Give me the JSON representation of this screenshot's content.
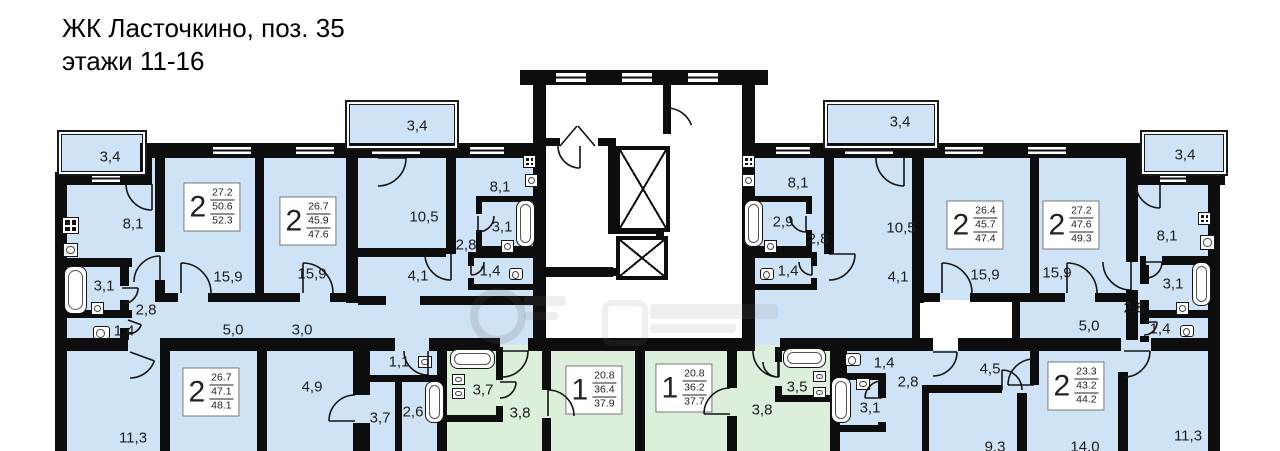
{
  "title": {
    "line1": "ЖК Ласточкино, поз. 35",
    "line2": "этажи 11-16"
  },
  "colors": {
    "room_blue": "#cfe3f6",
    "room_green": "#dcefda",
    "wall": "#0d0d0d"
  },
  "apartments": [
    {
      "rooms": "2",
      "living": "27.2",
      "area": "50.6",
      "total": "52.3",
      "x": 212,
      "y": 207
    },
    {
      "rooms": "2",
      "living": "26.7",
      "area": "45.9",
      "total": "47.6",
      "x": 308,
      "y": 221
    },
    {
      "rooms": "2",
      "living": "26.4",
      "area": "45.7",
      "total": "47.4",
      "x": 975,
      "y": 225
    },
    {
      "rooms": "2",
      "living": "27.2",
      "area": "47.6",
      "total": "49.3",
      "x": 1071,
      "y": 225
    },
    {
      "rooms": "2",
      "living": "26.7",
      "area": "47.1",
      "total": "48.1",
      "x": 211,
      "y": 392
    },
    {
      "rooms": "1",
      "living": "20.8",
      "area": "36.4",
      "total": "37.9",
      "x": 594,
      "y": 390
    },
    {
      "rooms": "1",
      "living": "20.8",
      "area": "36.2",
      "total": "37.7",
      "x": 684,
      "y": 388
    },
    {
      "rooms": "2",
      "living": "23.3",
      "area": "43.2",
      "total": "44.2",
      "x": 1076,
      "y": 386
    }
  ],
  "room_labels": [
    {
      "t": "3,4",
      "x": 110,
      "y": 157
    },
    {
      "t": "8,1",
      "x": 133,
      "y": 224
    },
    {
      "t": "3,1",
      "x": 104,
      "y": 286
    },
    {
      "t": "2,8",
      "x": 146,
      "y": 310
    },
    {
      "t": "1,4",
      "x": 124,
      "y": 331
    },
    {
      "t": "15,9",
      "x": 228,
      "y": 277
    },
    {
      "t": "15,9",
      "x": 312,
      "y": 274
    },
    {
      "t": "5,0",
      "x": 233,
      "y": 330
    },
    {
      "t": "3,0",
      "x": 302,
      "y": 330
    },
    {
      "t": "3,4",
      "x": 417,
      "y": 126
    },
    {
      "t": "10,5",
      "x": 424,
      "y": 217
    },
    {
      "t": "4,1",
      "x": 418,
      "y": 276
    },
    {
      "t": "8,1",
      "x": 500,
      "y": 187
    },
    {
      "t": "3,1",
      "x": 502,
      "y": 227
    },
    {
      "t": "2,8",
      "x": 466,
      "y": 245
    },
    {
      "t": "1,4",
      "x": 490,
      "y": 271
    },
    {
      "t": "3,4",
      "x": 900,
      "y": 122
    },
    {
      "t": "8,1",
      "x": 798,
      "y": 183
    },
    {
      "t": "2,9",
      "x": 783,
      "y": 222
    },
    {
      "t": "2,8",
      "x": 818,
      "y": 239
    },
    {
      "t": "1,4",
      "x": 788,
      "y": 271
    },
    {
      "t": "10,5",
      "x": 901,
      "y": 228
    },
    {
      "t": "4,1",
      "x": 898,
      "y": 277
    },
    {
      "t": "15,9",
      "x": 985,
      "y": 275
    },
    {
      "t": "15,9",
      "x": 1057,
      "y": 273
    },
    {
      "t": "5,0",
      "x": 1089,
      "y": 326
    },
    {
      "t": "2,8",
      "x": 1134,
      "y": 308
    },
    {
      "t": "8,1",
      "x": 1167,
      "y": 236
    },
    {
      "t": "3,1",
      "x": 1173,
      "y": 284
    },
    {
      "t": "1,4",
      "x": 1160,
      "y": 329
    },
    {
      "t": "3,4",
      "x": 1185,
      "y": 155
    },
    {
      "t": "11,3",
      "x": 133,
      "y": 438
    },
    {
      "t": "4,9",
      "x": 312,
      "y": 387
    },
    {
      "t": "1,1",
      "x": 399,
      "y": 362
    },
    {
      "t": "3,7",
      "x": 380,
      "y": 418
    },
    {
      "t": "2,6",
      "x": 413,
      "y": 412
    },
    {
      "t": "3,7",
      "x": 483,
      "y": 390
    },
    {
      "t": "3,8",
      "x": 520,
      "y": 413
    },
    {
      "t": "3,8",
      "x": 762,
      "y": 410
    },
    {
      "t": "3,5",
      "x": 797,
      "y": 387
    },
    {
      "t": "1,4",
      "x": 884,
      "y": 363
    },
    {
      "t": "2,8",
      "x": 908,
      "y": 382
    },
    {
      "t": "3,1",
      "x": 870,
      "y": 408
    },
    {
      "t": "4,5",
      "x": 990,
      "y": 369
    },
    {
      "t": "9,3",
      "x": 995,
      "y": 447
    },
    {
      "t": "14,0",
      "x": 1085,
      "y": 447
    },
    {
      "t": "11,3",
      "x": 1188,
      "y": 436
    }
  ]
}
